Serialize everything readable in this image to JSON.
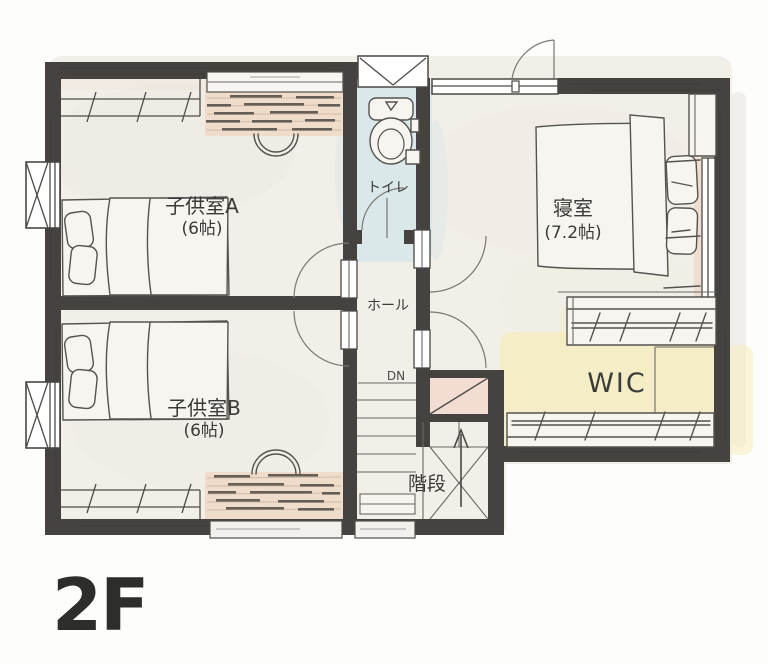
{
  "floor_plan": {
    "floor_label": "2F",
    "rooms": {
      "kids_a": {
        "name": "子供室A",
        "size": "(6帖)"
      },
      "kids_b": {
        "name": "子供室B",
        "size": "(6帖)"
      },
      "bedroom": {
        "name": "寝室",
        "size": "(7.2帖)"
      },
      "toilet": {
        "name": "トイレ"
      },
      "hall": {
        "name": "ホール"
      },
      "wic": {
        "name": "WIC"
      },
      "stairs": {
        "name": "階段"
      }
    },
    "annotations": {
      "stairs_direction": "DN"
    },
    "colors": {
      "wall": "#454240",
      "floor": "#f2efe8",
      "toilet_wash": "#d5e6e9",
      "wic_wash": "#f5ecbe",
      "closet_wood": "#f0dccb",
      "storage_pink": "#f3dcd2",
      "sketch_line": "#55534f",
      "label_text": "#3a3a38"
    }
  }
}
